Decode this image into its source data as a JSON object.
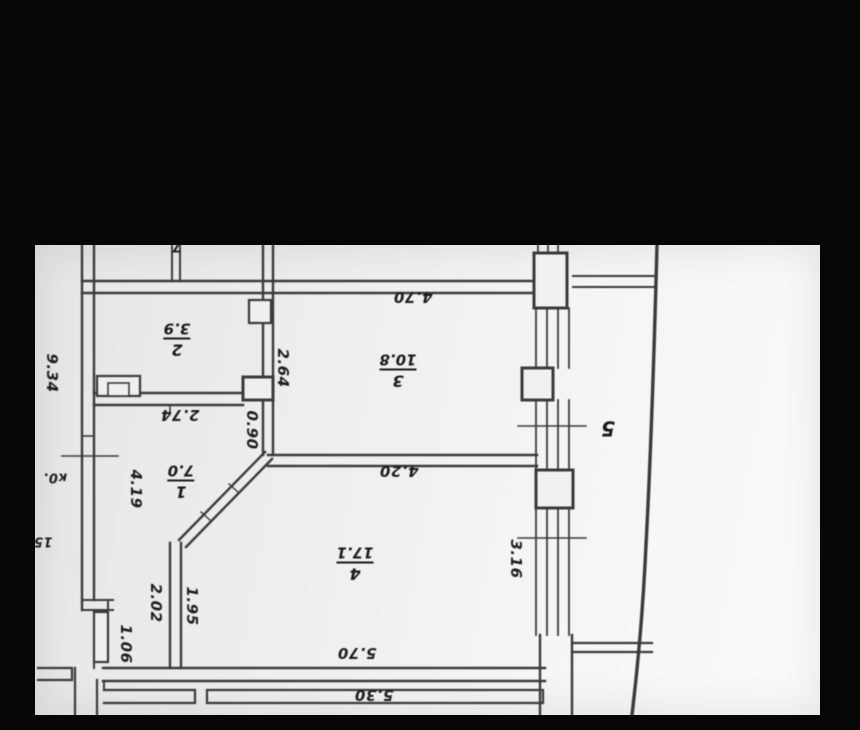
{
  "colors": {
    "background": "#060606",
    "paper": "#f0efed",
    "paper_bright": "#fbfbfa",
    "line": "#3a3a3a",
    "text": "#1d1d1d"
  },
  "plan": {
    "kind": "scanned apartment floor plan, rotated 180 degrees",
    "rooms": [
      {
        "id": "room-1",
        "number": "1",
        "area": "7.0"
      },
      {
        "id": "room-2",
        "number": "2",
        "area": "3.9"
      },
      {
        "id": "room-3",
        "number": "3",
        "area": "10.8"
      },
      {
        "id": "room-4",
        "number": "4",
        "area": "17.1"
      },
      {
        "id": "room-5",
        "number": "5",
        "area": ""
      }
    ],
    "dimensions": {
      "outer_left": "9.34",
      "room3_top": "4.70",
      "room3_left": "2.64",
      "room1_top": "2.74",
      "room1_right": "0.90",
      "room3_bottom": "4.20",
      "room1_left": "4.19",
      "closet_top": "2.02",
      "room4_left": "1.95",
      "closet_left": "1.06",
      "room4_bottom": "5.70",
      "outer_bottom": "5.30",
      "balcony_wall": "3.16"
    },
    "partial_labels": {
      "top_edge": "7",
      "left_upper": "к0.",
      "left_lower": "15"
    }
  }
}
